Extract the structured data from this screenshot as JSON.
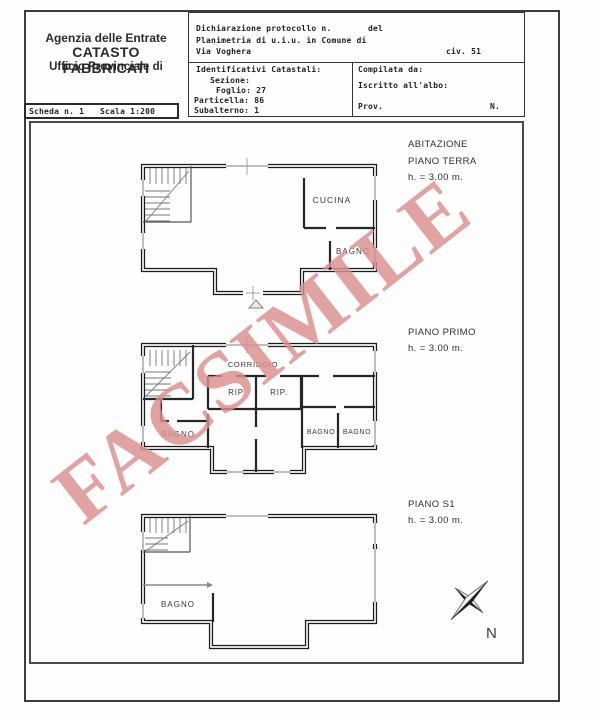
{
  "colors": {
    "watermark": "#dc8f8f"
  },
  "header": {
    "line1": "Agenzia delle Entrate",
    "line2": "CATASTO FABBRICATI",
    "line3": "Ufficio Provinciale di"
  },
  "scheda": {
    "number": "Scheda n. 1",
    "scale": "Scala 1:200"
  },
  "form": {
    "protocollo": "Dichiarazione protocollo n.",
    "del": "del",
    "planimetria": "Planimetria di u.i.u. in Comune di",
    "street": "Via Voghera",
    "civic": "civ. 51",
    "identificativi": "Identificativi Catastali:",
    "sezione": "Sezione:",
    "foglio": "Foglio: 27",
    "particella": "Particella: 86",
    "subalterno": "Subalterno: 1",
    "compilata": "Compilata da:",
    "iscritto": "Iscritto all'albo:",
    "prov": "Prov.",
    "n": "N."
  },
  "plans": [
    {
      "title_line1": "ABITAZIONE",
      "title_line2": "PIANO TERRA",
      "height_label": "h. = 3.00 m.",
      "rooms": {
        "cucina": "CUCINA",
        "bagno": "BAGNO"
      }
    },
    {
      "title_line1": "PIANO PRIMO",
      "height_label": "h. = 3.00 m.",
      "rooms": {
        "corridoio": "CORRIDOIO",
        "rip1": "RIP.",
        "rip2": "RIP.",
        "bagno_left": "BAGNO",
        "bagno_mid": "BAGNO",
        "bagno_right": "BAGNO"
      }
    },
    {
      "title_line1": "PIANO S1",
      "height_label": "h. = 3.00 m.",
      "rooms": {
        "bagno": "BAGNO"
      }
    }
  ],
  "compass": {
    "north": "N"
  },
  "watermark": {
    "text": "FACSIMILE"
  }
}
